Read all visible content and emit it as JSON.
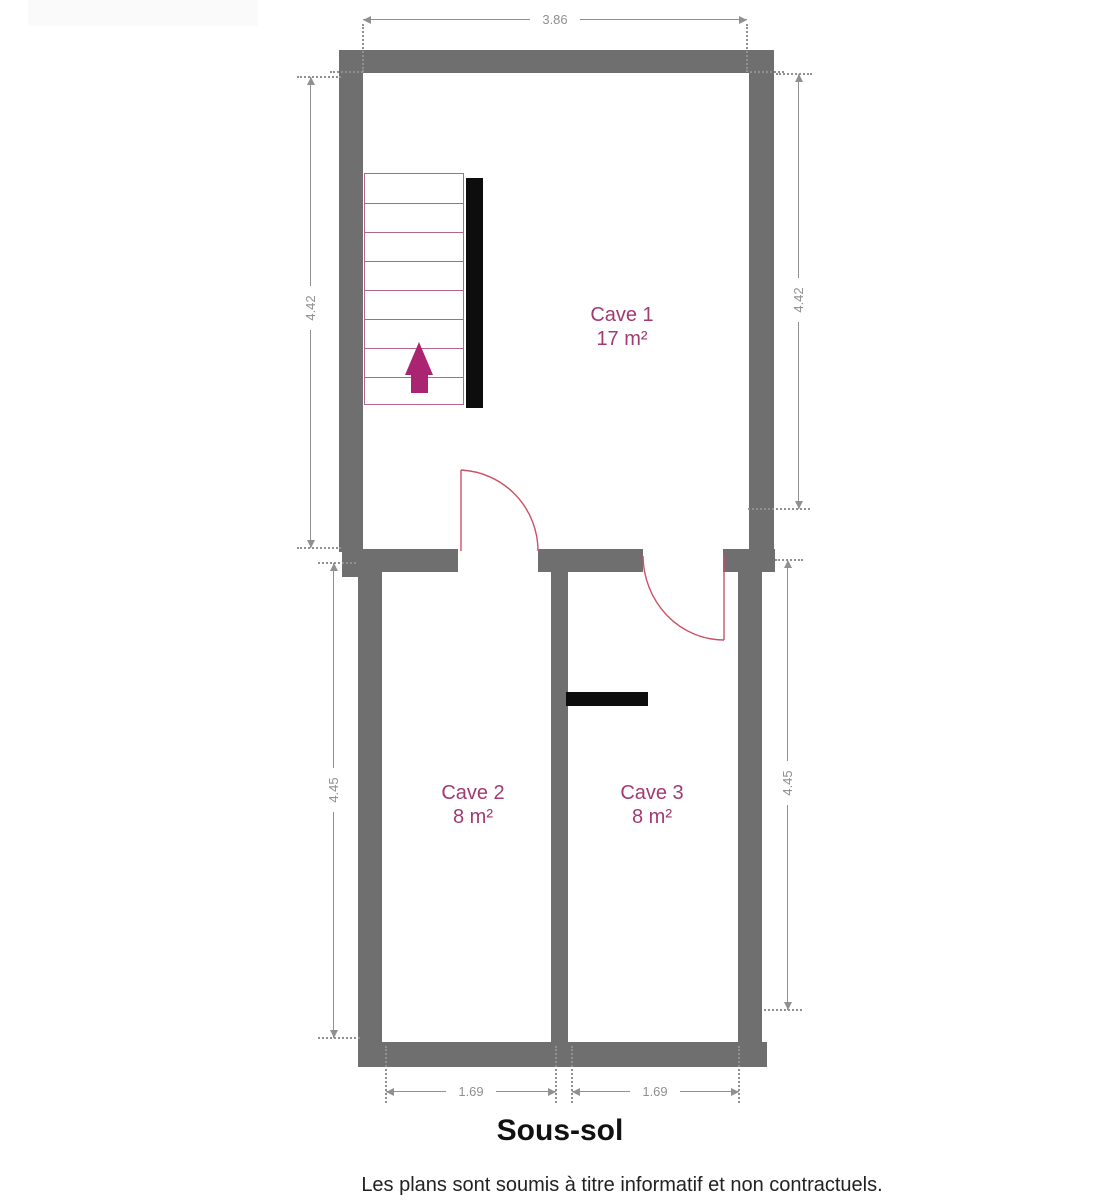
{
  "plan": {
    "title": "Sous-sol",
    "disclaimer": "Les plans sont soumis à titre informatif et non contractuels.",
    "rooms": [
      {
        "name": "Cave 1",
        "area": "17 m²"
      },
      {
        "name": "Cave 2",
        "area": "8 m²"
      },
      {
        "name": "Cave 3",
        "area": "8 m²"
      }
    ],
    "dimensions": {
      "top": "3.86",
      "upper_left": "4.42",
      "upper_right": "4.42",
      "lower_left": "4.45",
      "lower_right": "4.45",
      "bottom_left": "1.69",
      "bottom_right": "1.69"
    },
    "stairs": {
      "direction": "up",
      "steps": 8
    },
    "colors": {
      "wall": "#6f6f6f",
      "dimension": "#909090",
      "room_label": "#a23a72",
      "arrow": "#aa2472",
      "stair_line": "#b5648e",
      "door_arc": "#cc5166",
      "black_feature": "#0d0d0d"
    }
  }
}
